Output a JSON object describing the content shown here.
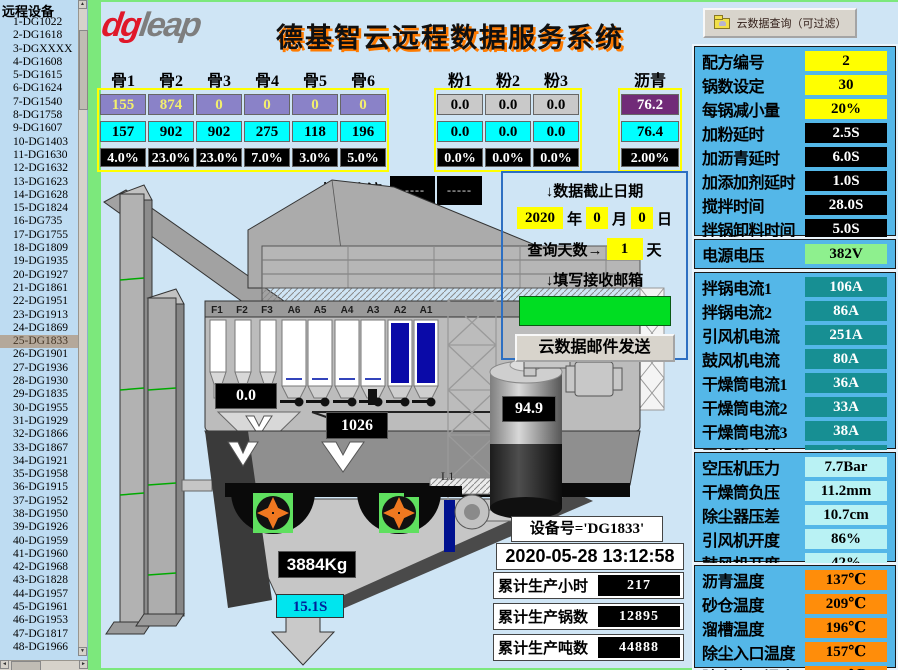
{
  "sidebar": {
    "title": "远程设备",
    "selected_device": "25-DG1833",
    "devices": [
      "1-DG1022",
      "2-DG1618",
      "3-DGXXXX",
      "4-DG1608",
      "5-DG1615",
      "6-DG1624",
      "7-DG1540",
      "8-DG1758",
      "9-DG1607",
      "10-DG1403",
      "11-DG1630",
      "12-DG1632",
      "13-DG1623",
      "14-DG1628",
      "15-DG1824",
      "16-DG735",
      "17-DG1755",
      "18-DG1809",
      "19-DG1935",
      "20-DG1927",
      "21-DG1861",
      "22-DG1951",
      "23-DG1913",
      "24-DG1869",
      "25-DG1833",
      "26-DG1901",
      "27-DG1936",
      "28-DG1930",
      "29-DG1835",
      "30-DG1955",
      "31-DG1929",
      "32-DG1866",
      "33-DG1867",
      "34-DG1921",
      "35-DG1958",
      "36-DG1915",
      "37-DG1952",
      "38-DG1950",
      "39-DG1926",
      "40-DG1959",
      "41-DG1960",
      "42-DG1968",
      "43-DG1828",
      "44-DG1957",
      "45-DG1961",
      "46-DG1953",
      "47-DG1817",
      "48-DG1966"
    ]
  },
  "header": {
    "logo_dg": "dg",
    "logo_leap": "leap",
    "title": "德基智云远程数据服务系统",
    "query_button": "云数据查询（可过滤）"
  },
  "materials": {
    "bone": [
      {
        "header": "骨1",
        "target": "155",
        "actual": "157",
        "ratio": "4.0%"
      },
      {
        "header": "骨2",
        "target": "874",
        "actual": "902",
        "ratio": "23.0%"
      },
      {
        "header": "骨3",
        "target": "0",
        "actual": "902",
        "ratio": "23.0%"
      },
      {
        "header": "骨4",
        "target": "0",
        "actual": "275",
        "ratio": "7.0%"
      },
      {
        "header": "骨5",
        "target": "0",
        "actual": "118",
        "ratio": "3.0%"
      },
      {
        "header": "骨6",
        "target": "0",
        "actual": "196",
        "ratio": "5.0%"
      }
    ],
    "powder": [
      {
        "header": "粉1",
        "target": "0.0",
        "actual": "0.0",
        "ratio": "0.0%"
      },
      {
        "header": "粉2",
        "target": "0.0",
        "actual": "0.0",
        "ratio": "0.0%"
      },
      {
        "header": "粉3",
        "target": "0.0",
        "actual": "0.0",
        "ratio": "0.0%"
      }
    ],
    "asphalt": [
      {
        "header": "沥青",
        "target": "76.2",
        "actual": "76.4",
        "ratio": "2.00%"
      }
    ]
  },
  "diagram": {
    "screen_current_label": "振筛电流",
    "screen_current_1": "-----",
    "screen_current_2": "-----",
    "fine_bins": [
      "F1",
      "F2",
      "F3"
    ],
    "hot_bins": [
      "A6",
      "A5",
      "A4",
      "A3",
      "A2",
      "A1"
    ],
    "fine_weight": "0.0",
    "aggregate_weight": "1026",
    "mix_weight": "3884Kg",
    "discharge_time": "15.1S",
    "asphalt_weight": "94.9",
    "pipe_label": "L1"
  },
  "query_panel": {
    "date_title": "↓数据截止日期",
    "year": "2020",
    "year_unit": "年",
    "month": "0",
    "month_unit": "月",
    "day": "0",
    "day_unit": "日",
    "days_label": "查询天数→",
    "days": "1",
    "days_unit": "天",
    "email_title": "↓填写接收邮箱",
    "email_value": "",
    "send_button": "云数据邮件发送"
  },
  "stats": {
    "device_label": "设备号='DG1833'",
    "datetime": "2020-05-28 13:12:58",
    "rows": [
      {
        "label": "累计生产小时",
        "value": "217"
      },
      {
        "label": "累计生产锅数",
        "value": "12895"
      },
      {
        "label": "累计生产吨数",
        "value": "44888"
      }
    ]
  },
  "right_panel": {
    "params": [
      {
        "label": "配方编号",
        "value": "2",
        "cls": "yellow"
      },
      {
        "label": "锅数设定",
        "value": "30",
        "cls": "yellow"
      },
      {
        "label": "每锅减小量",
        "value": "20%",
        "cls": "yellow"
      },
      {
        "label": "加粉延时",
        "value": "2.5S",
        "cls": "dark"
      },
      {
        "label": "加沥青延时",
        "value": "6.0S",
        "cls": "dark"
      },
      {
        "label": "加添加剂延时",
        "value": "1.0S",
        "cls": "dark"
      },
      {
        "label": "搅拌时间",
        "value": "28.0S",
        "cls": "dark"
      },
      {
        "label": "拌锅卸料时间",
        "value": "5.0S",
        "cls": "dark"
      }
    ],
    "power": {
      "label": "电源电压",
      "value": "382V"
    },
    "currents": [
      {
        "label": "拌锅电流1",
        "value": "106A"
      },
      {
        "label": "拌锅电流2",
        "value": "86A"
      },
      {
        "label": "引风机电流",
        "value": "251A"
      },
      {
        "label": "鼓风机电流",
        "value": "80A"
      },
      {
        "label": "干燥筒电流1",
        "value": "36A"
      },
      {
        "label": "干燥筒电流2",
        "value": "33A"
      },
      {
        "label": "干燥筒电流3",
        "value": "38A"
      },
      {
        "label": "干燥筒电流4",
        "value": "38A"
      }
    ],
    "pressures": [
      {
        "label": "空压机压力",
        "value": "7.7Bar"
      },
      {
        "label": "干燥筒负压",
        "value": "11.2mm"
      },
      {
        "label": "除尘器压差",
        "value": "10.7cm"
      },
      {
        "label": "引风机开度",
        "value": "86%"
      },
      {
        "label": "鼓风机开度",
        "value": "42%"
      }
    ],
    "temperatures": [
      {
        "label": "沥青温度",
        "value": "137℃"
      },
      {
        "label": "砂仓温度",
        "value": "209℃"
      },
      {
        "label": "溜槽温度",
        "value": "196℃"
      },
      {
        "label": "除尘入口温度",
        "value": "157℃"
      },
      {
        "label": "除尘出口温度",
        "value": "127℃"
      }
    ]
  },
  "colors": {
    "accent_green_strip": "#7ce87c",
    "panel_blue": "#54b7e8",
    "title_shadow_orange": "#ff7b00",
    "highlight_yellow": "#ffff00",
    "actual_cyan": "#00ffff"
  }
}
